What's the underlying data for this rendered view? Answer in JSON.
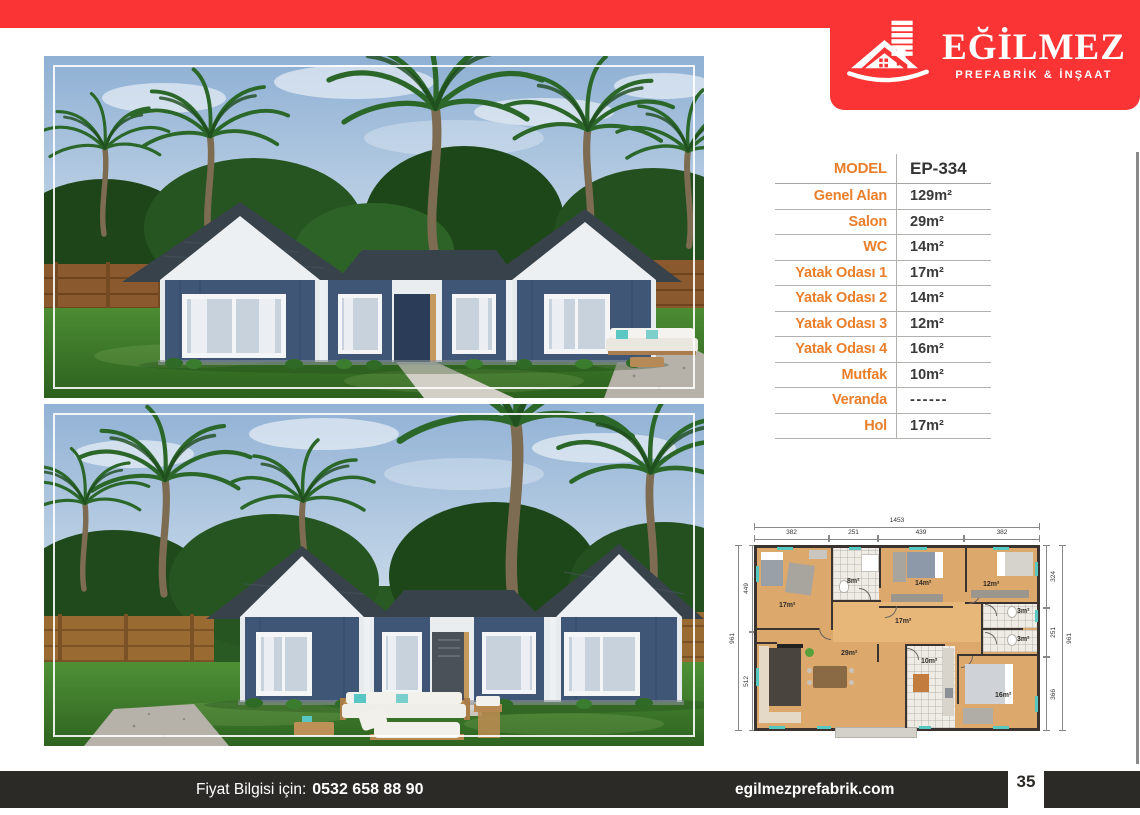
{
  "brand": {
    "title": "EĞİLMEZ",
    "subtitle": "PREFABRİK & İNŞAAT"
  },
  "colors": {
    "accent_red": "#fa3434",
    "accent_orange": "#e97e2b",
    "footer_bg": "#2b2a27",
    "navy_wall": "#405677",
    "roof": "#39434b"
  },
  "spec_table": {
    "rows": [
      {
        "label": "MODEL",
        "value": "EP-334"
      },
      {
        "label": "Genel Alan",
        "value": "129m²"
      },
      {
        "label": "Salon",
        "value": "29m²"
      },
      {
        "label": "WC",
        "value": "14m²"
      },
      {
        "label": "Yatak Odası 1",
        "value": "17m²"
      },
      {
        "label": "Yatak Odası 2",
        "value": "14m²"
      },
      {
        "label": "Yatak Odası 3",
        "value": "12m²"
      },
      {
        "label": "Yatak Odası 4",
        "value": "16m²"
      },
      {
        "label": "Mutfak",
        "value": "10m²"
      },
      {
        "label": "Veranda",
        "value": "------"
      },
      {
        "label": "Hol",
        "value": "17m²"
      }
    ]
  },
  "floor_plan": {
    "dims": {
      "total_top": "1453",
      "top": [
        "382",
        "251",
        "439",
        "382"
      ],
      "left_outer": "961",
      "left": [
        "449",
        "512"
      ],
      "right": [
        "324",
        "251",
        "366"
      ],
      "right_outer": "961"
    },
    "rooms": [
      "17m²",
      "8m²",
      "14m²",
      "12m²",
      "17m²",
      "3m²",
      "3m²",
      "29m²",
      "10m²",
      "16m²"
    ]
  },
  "footer": {
    "price_label": "Fiyat Bilgisi için:",
    "phone": "0532 658 88 90",
    "website": "egilmezprefabrik.com",
    "page_number": "35"
  }
}
